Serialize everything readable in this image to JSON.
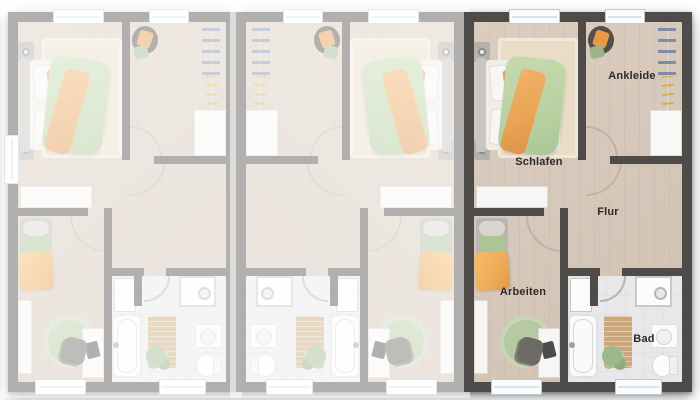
{
  "floorplan": {
    "units": [
      {
        "name": "unit-left",
        "state": "dimmed"
      },
      {
        "name": "unit-middle",
        "state": "dimmed",
        "mirrored": true
      },
      {
        "name": "unit-right",
        "state": "highlighted"
      }
    ],
    "room_labels": {
      "schlafen": "Schlafen",
      "ankleide": "Ankleide",
      "flur": "Flur",
      "arbeiten": "Arbeiten",
      "bad": "Bad"
    },
    "colors": {
      "wall_dark": "#4f4b48",
      "wall_dimmed": "#a5a3a1",
      "floor_wood": "#d6c8ba",
      "floor_bath": "#e8e8ea",
      "stair_wood": "#ebe2d4",
      "accent_orange": "#eda75c",
      "accent_green": "#b9d2a2",
      "rug_green": "#b6c9a0",
      "window_glass": "#d7e4ec"
    }
  }
}
